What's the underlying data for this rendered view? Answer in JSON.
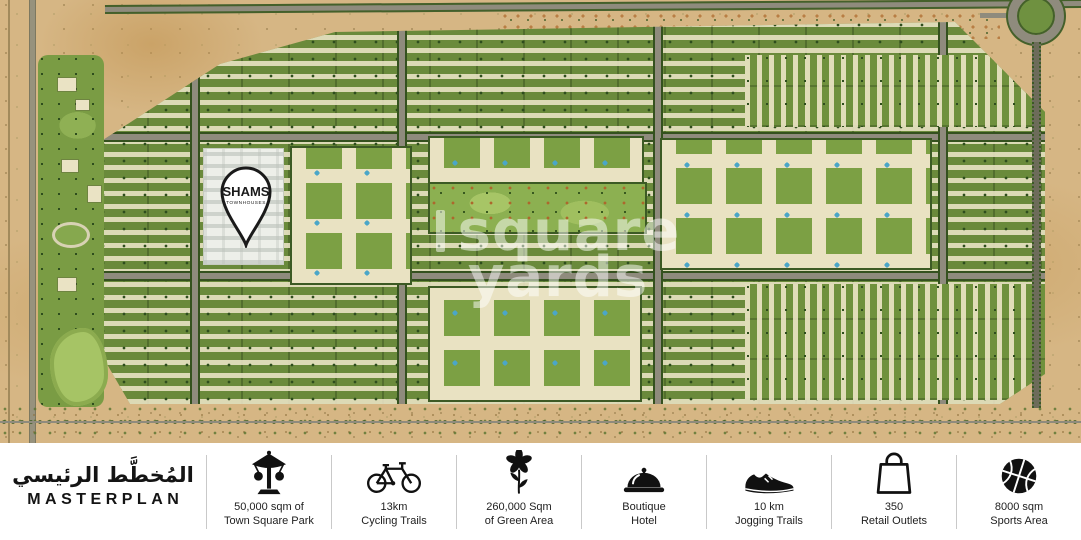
{
  "map": {
    "pin": {
      "title": "SHAMS",
      "subtitle": "TOWNHOUSES"
    },
    "watermark": {
      "line1": "square",
      "line2": "yards"
    }
  },
  "legend": {
    "title_ar": "المُخطَّط الرئيسي",
    "title_en": "MASTERPLAN",
    "amenities": [
      {
        "icon": "carousel-ride-icon",
        "line1": "50,000 sqm of",
        "line2": "Town Square Park"
      },
      {
        "icon": "bicycle-icon",
        "line1": "13km",
        "line2": "Cycling Trails"
      },
      {
        "icon": "flower-icon",
        "line1": "260,000 Sqm",
        "line2": "of Green Area"
      },
      {
        "icon": "hotel-bell-icon",
        "line1": "Boutique",
        "line2": "Hotel"
      },
      {
        "icon": "sneaker-icon",
        "line1": "10 km",
        "line2": "Jogging Trails"
      },
      {
        "icon": "shopping-bag-icon",
        "line1": "350",
        "line2": "Retail Outlets"
      },
      {
        "icon": "basketball-icon",
        "line1": "8000 sqm",
        "line2": "Sports Area"
      }
    ]
  },
  "colors": {
    "sand": "#d6b684",
    "greenery": "#6a8a3b",
    "road_gray": "#8f8b7d",
    "accent_black": "#141414",
    "divider_gray": "#c9c9c9",
    "pool_blue": "#4aa6c8"
  }
}
